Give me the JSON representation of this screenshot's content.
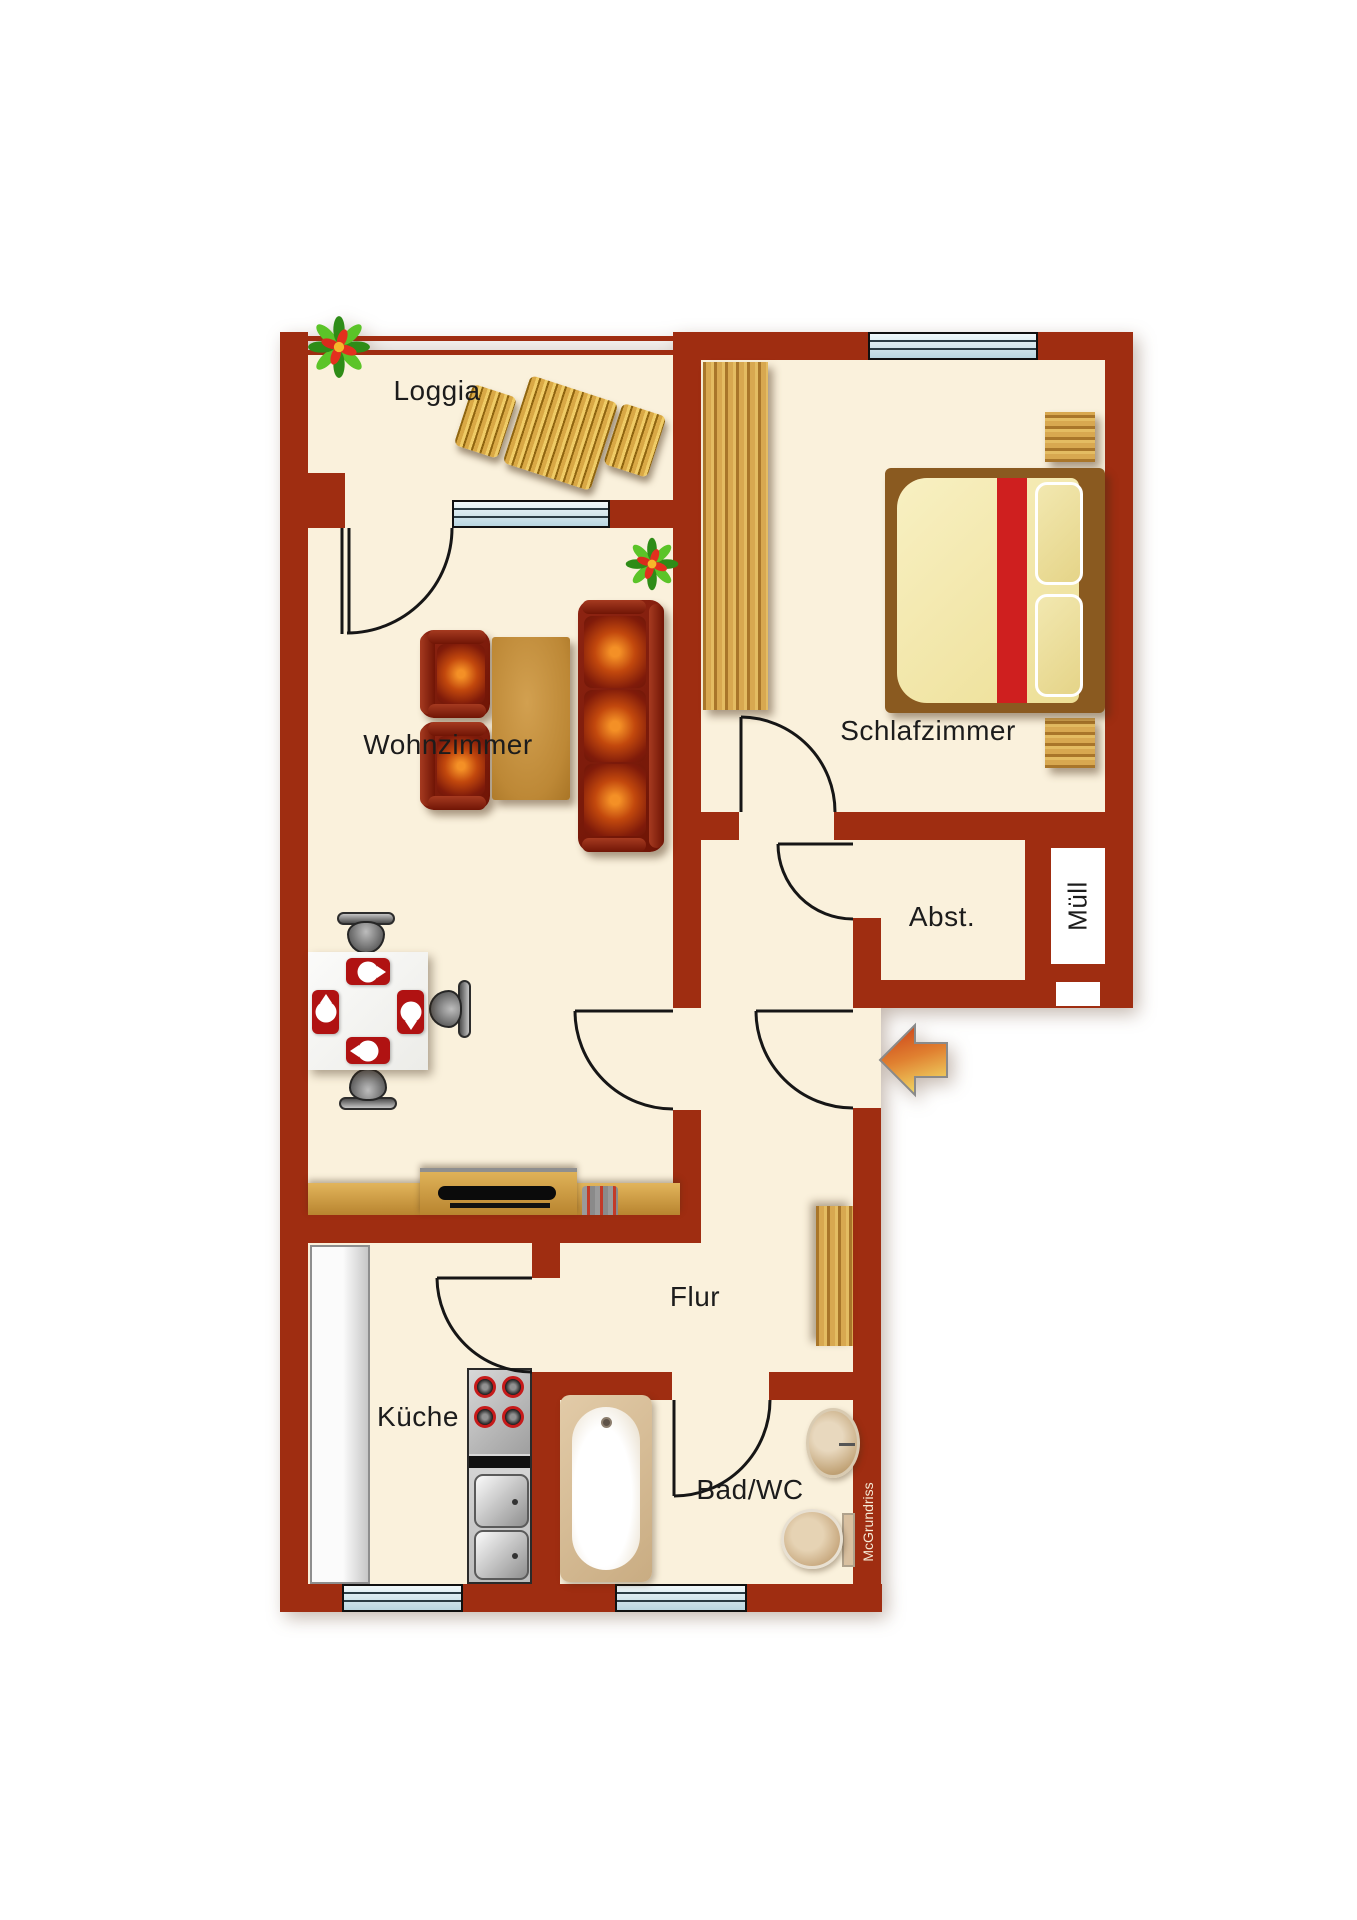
{
  "floorplan": {
    "watermark": "McGrundriss",
    "rooms": {
      "loggia": {
        "label": "Loggia"
      },
      "schlafzimmer": {
        "label": "Schlafzimmer"
      },
      "wohnzimmer": {
        "label": "Wohnzimmer"
      },
      "abstellraum": {
        "label": "Abst."
      },
      "muell": {
        "label": "Müll"
      },
      "flur": {
        "label": "Flur"
      },
      "kueche": {
        "label": "Küche"
      },
      "bad": {
        "label": "Bad/WC"
      }
    },
    "colors": {
      "wall": "#9F2D11",
      "floor": "#FAF1DC",
      "window-glass-light": "#F0F8FA",
      "window-glass-dark": "#B9D6E0",
      "door-line": "#161616",
      "wood-light": "#D8A850",
      "wood-dark": "#A9762A",
      "sofa-body": "#741708",
      "cushion-glow": "#F07010",
      "bed-mattress": "#F3E7AC",
      "bed-runner": "#CF1F1F",
      "mat-red": "#B01212",
      "arrow-start": "#C93A17",
      "arrow-mid": "#E08030",
      "arrow-end": "#EFD060",
      "watermark-color": "#F5EAD5"
    }
  }
}
